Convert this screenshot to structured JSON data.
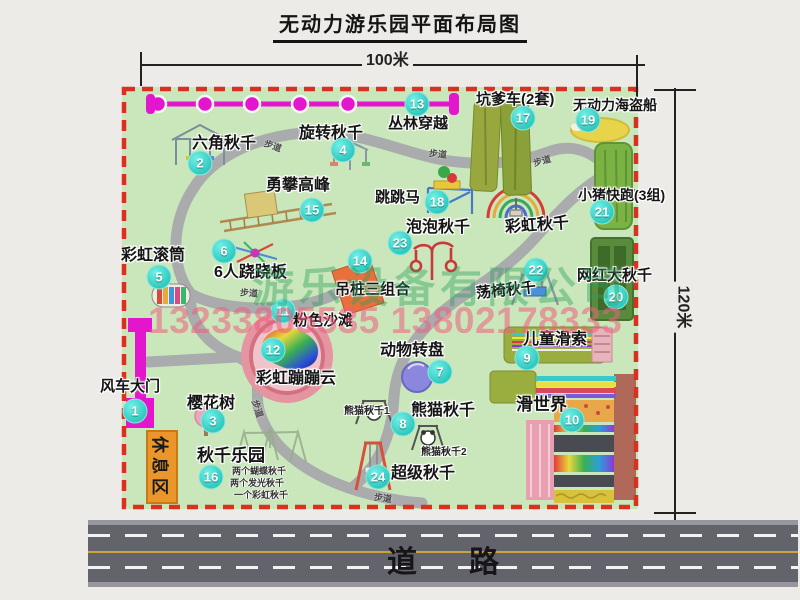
{
  "title": "无动力游乐园平面布局图",
  "dimensions": {
    "width": "100米",
    "height": "120米"
  },
  "road": {
    "label": "道路"
  },
  "rest_area": {
    "label": "休息区"
  },
  "watermark": {
    "company": "游乐设备有限公司",
    "phone": "13233805535 13802178333"
  },
  "path_label": "步道",
  "colors": {
    "map_green": "#cae7bc",
    "border_red": "#d93020",
    "magenta": "#e316ce",
    "badge_cyan": "#2ec9bf",
    "road_gray": "#63636b",
    "rest_orange": "#ea962b"
  },
  "attractions": [
    {
      "num": "1",
      "label": "风车大门"
    },
    {
      "num": "2",
      "label": "六角秋千"
    },
    {
      "num": "3",
      "label": "樱花树"
    },
    {
      "num": "4",
      "label": "旋转秋千"
    },
    {
      "num": "5",
      "label": "彩虹滚筒"
    },
    {
      "num": "6",
      "label": "6人跷跷板"
    },
    {
      "num": "7",
      "label": "动物转盘"
    },
    {
      "num": "8",
      "label": "熊猫秋千"
    },
    {
      "num": "9",
      "label": "儿童滑索"
    },
    {
      "num": "10",
      "label": "滑世界"
    },
    {
      "num": "11",
      "label": "粉色沙滩"
    },
    {
      "num": "12",
      "label": "彩虹蹦蹦云"
    },
    {
      "num": "13",
      "label": "丛林穿越"
    },
    {
      "num": "14",
      "label": "吊桩三组合"
    },
    {
      "num": "15",
      "label": "勇攀高峰"
    },
    {
      "num": "16",
      "label": "秋千乐园",
      "notes": [
        "两个蝴蝶秋千",
        "两个发光秋千",
        "一个彩虹秋千"
      ]
    },
    {
      "num": "17",
      "label": "坑爹车(2套)"
    },
    {
      "num": "18",
      "label": "跳跳马"
    },
    {
      "num": "19",
      "label": "无动力海盗船"
    },
    {
      "num": "20",
      "label": "网红大秋千"
    },
    {
      "num": "21",
      "label": "小猪快跑(3组)"
    },
    {
      "num": "22",
      "label": "荡椅秋千"
    },
    {
      "num": "23",
      "label": "泡泡秋千"
    },
    {
      "num": "24",
      "label": "超级秋千"
    }
  ],
  "extra_labels": {
    "rainbow_swing": "彩虹秋千",
    "panda1": "熊猫秋千1",
    "panda2": "熊猫秋千2"
  }
}
